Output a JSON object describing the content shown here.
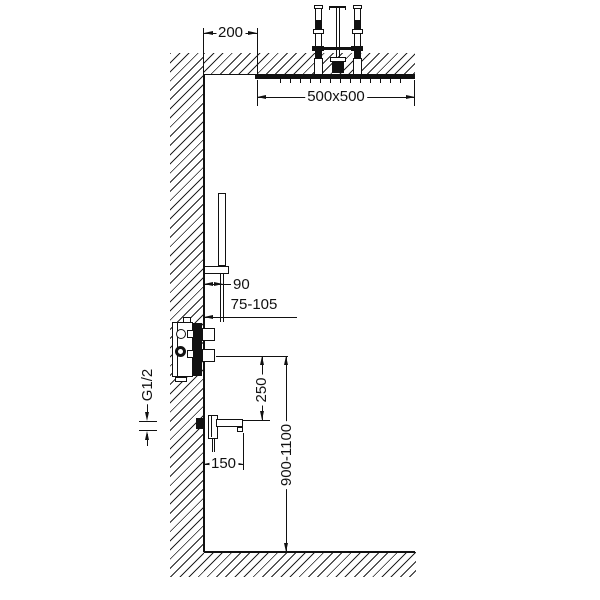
{
  "drawing": {
    "type": "shower-installation-dimension-diagram",
    "colors": {
      "line": "#111111",
      "background": "#ffffff"
    },
    "dimensions": {
      "ceiling_offset": "200",
      "head_size": "500x500",
      "hand_shower_offset": "90",
      "mounting_depth_range": "75-105",
      "connection_thread": "G1/2",
      "valve_to_spout": "250",
      "spout_reach": "150",
      "valve_height_range": "900-1100"
    }
  }
}
